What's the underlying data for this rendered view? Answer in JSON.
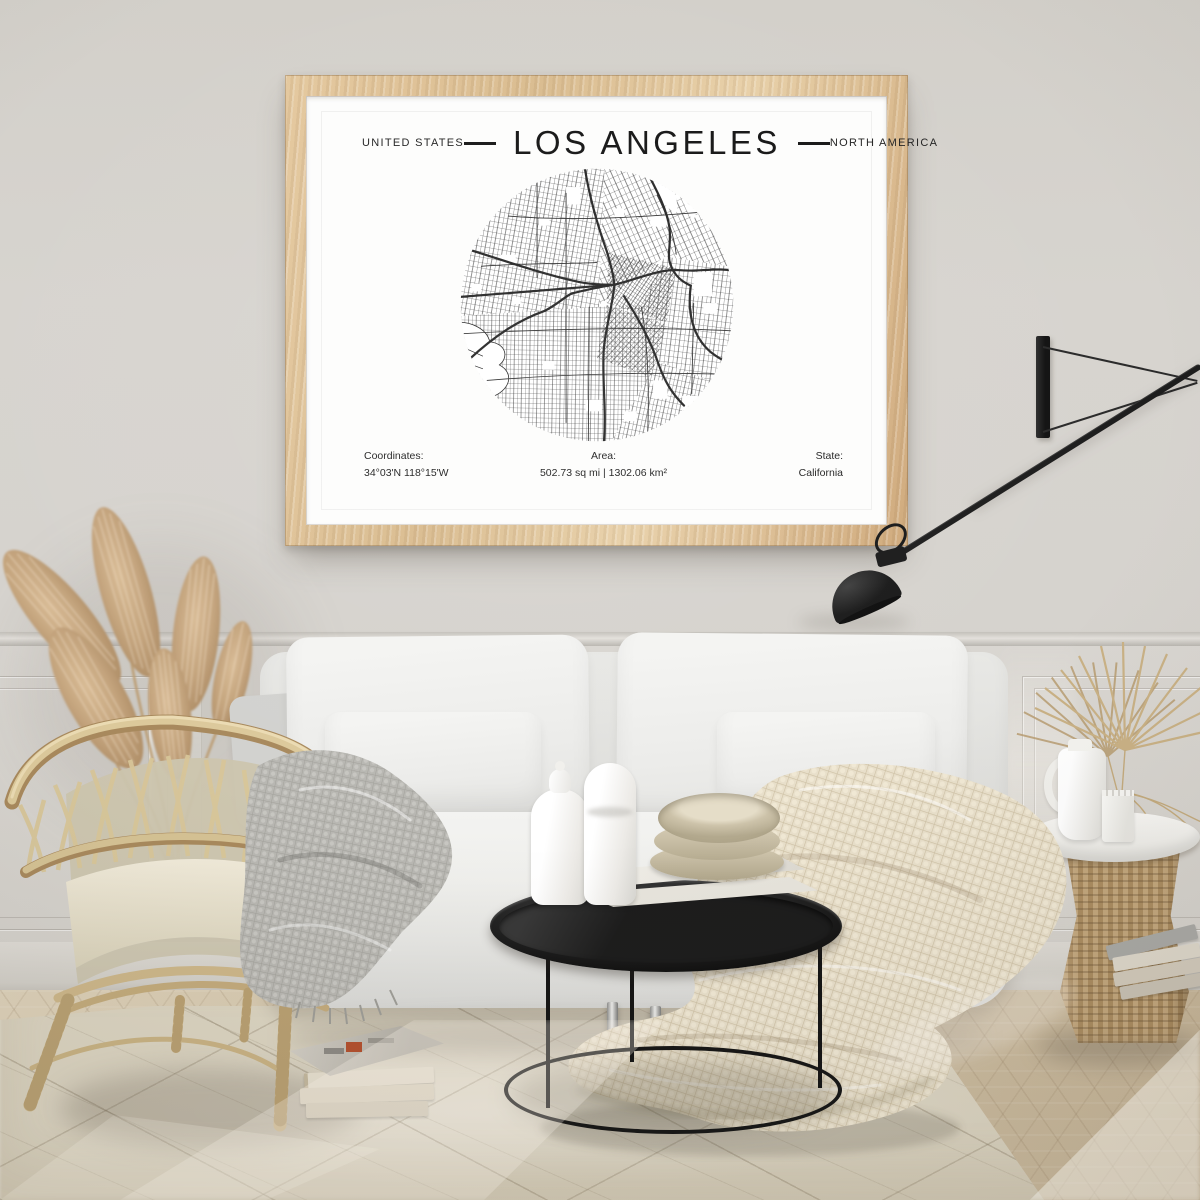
{
  "poster": {
    "label_left": "UNITED STATES",
    "title": "LOS ANGELES",
    "label_right": "NORTH AMERICA",
    "footer": {
      "coordinates_label": "Coordinates:",
      "coordinates_value": "34°03'N 118°15'W",
      "area_label": "Area:",
      "area_value": "502.73 sq mi | 1302.06 km²",
      "state_label": "State:",
      "state_value": "California"
    }
  },
  "colors": {
    "frame_wood": "#d9bb8e",
    "poster_paper": "#fdfdfc",
    "map_ink": "#262626",
    "lamp_black": "#1d1d1d",
    "wall": "#d6d3ce",
    "rattan": "#d8c699",
    "throw_gray": "#b8b7b2",
    "throw_cream": "#e8dfca",
    "rug": "#dcd5c2",
    "floor_wood": "#d3c5ab"
  }
}
